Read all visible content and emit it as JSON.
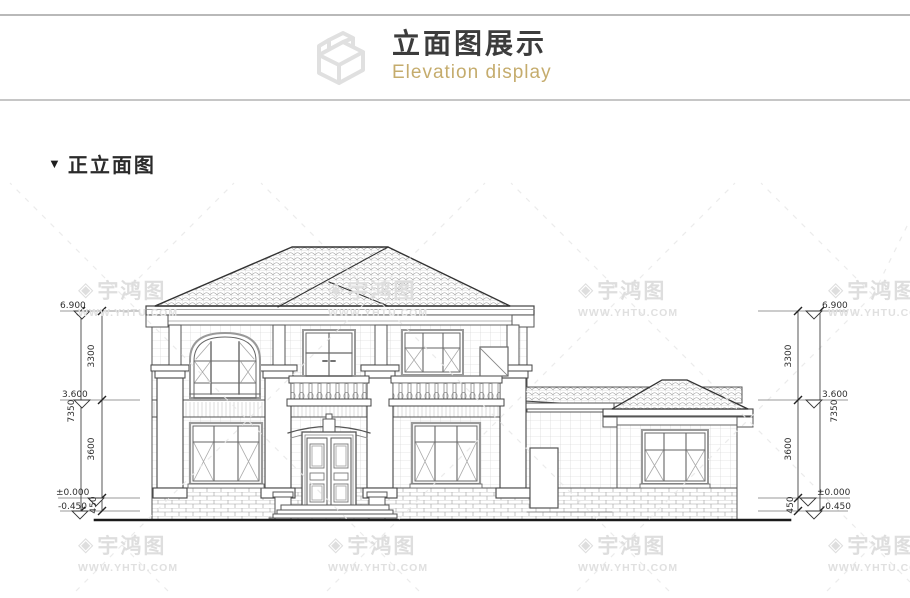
{
  "header": {
    "title": "立面图展示",
    "subtitle": "Elevation display",
    "accent_color": "#c5ac6d",
    "icon": "elevation-3d-box-icon"
  },
  "section": {
    "marker": "▼",
    "label": "正立面图"
  },
  "watermark": {
    "logo_glyph": "◈",
    "brand": "宇鸿图",
    "url": "WWW.YHTU.COM",
    "color": "#dcdcdc"
  },
  "elevation": {
    "name": "正立面图",
    "levels": [
      {
        "id": "eave",
        "label": "6.900"
      },
      {
        "id": "second-floor",
        "label": "3.600"
      },
      {
        "id": "ground",
        "label": "±0.000"
      },
      {
        "id": "grade",
        "label": "-0.450"
      }
    ],
    "segment_dims": [
      {
        "id": "upper-storey",
        "label": "3300"
      },
      {
        "id": "lower-storey",
        "label": "3600"
      },
      {
        "id": "plinth",
        "label": "450"
      }
    ],
    "overall_dim": "7350"
  }
}
